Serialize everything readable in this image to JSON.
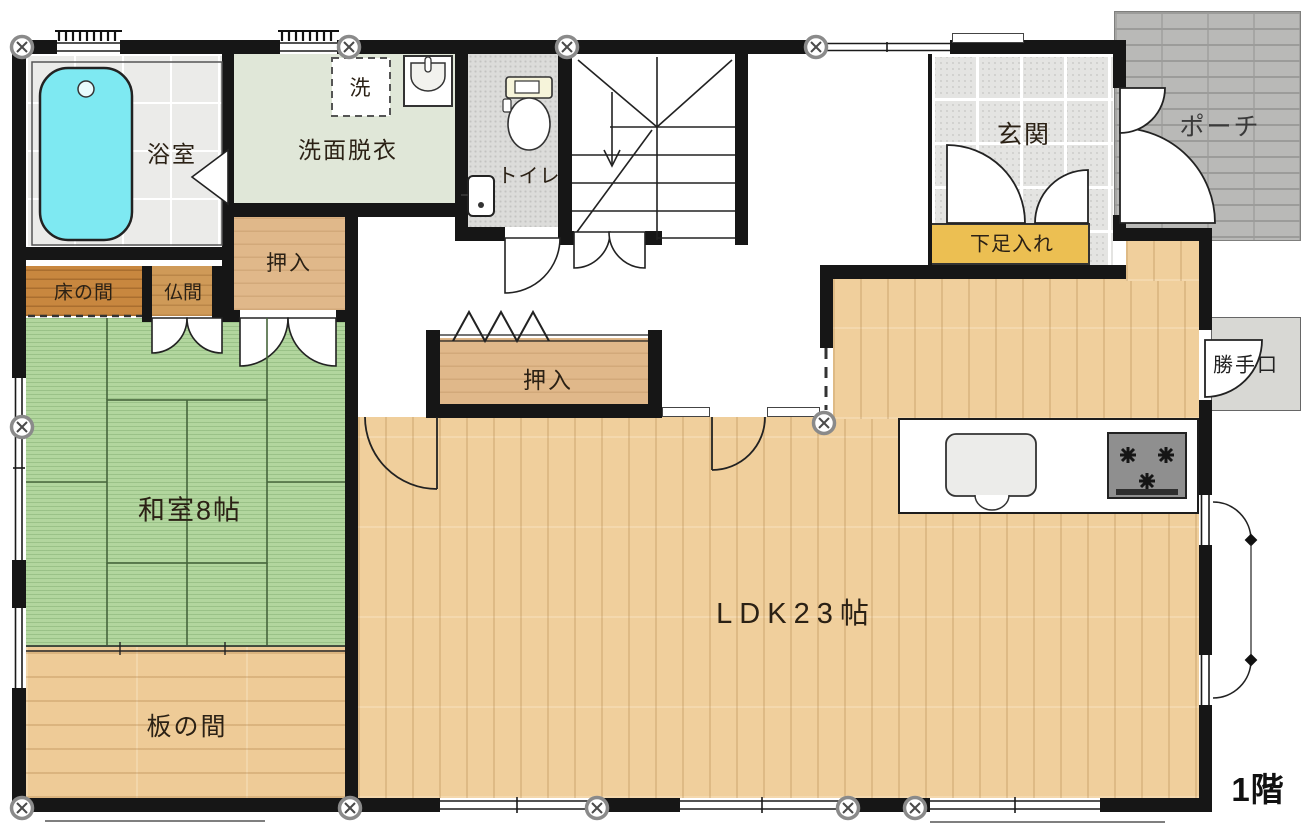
{
  "rooms": {
    "bathroom": {
      "label": "浴室"
    },
    "washroom": {
      "label": "洗面脱衣"
    },
    "washer": {
      "label": "洗"
    },
    "toilet": {
      "label": "トイレ"
    },
    "entrance": {
      "label": "玄関"
    },
    "porch": {
      "label": "ポーチ"
    },
    "shoe_cabinet": {
      "label": "下足入れ"
    },
    "closet_upper": {
      "label": "押入"
    },
    "closet_center": {
      "label": "押入"
    },
    "tokonoma": {
      "label": "床の間"
    },
    "butsuma": {
      "label": "仏間"
    },
    "washitsu": {
      "label": "和室8帖"
    },
    "itanoma": {
      "label": "板の間"
    },
    "ldk": {
      "label": "LDK23帖"
    },
    "back_door": {
      "label": "勝手口"
    },
    "floor": {
      "label": "1階"
    }
  },
  "fixtures": [
    "bathtub",
    "washbasin",
    "washing-machine-space",
    "toilet",
    "hand-basin",
    "staircase-down",
    "kitchen-sink",
    "gas-stove"
  ],
  "colors": {
    "wall": "#161616",
    "tatami": "#b2d69e",
    "wood_floor": "#f0cf9c",
    "plank_floor": "#eecb97",
    "closet_wood": "#e0b88a",
    "tokonoma_wood": "#c8873f",
    "butsuma_wood": "#cf9a58",
    "bathtub": "#7ee9f2",
    "bath_tile": "#ebebe9",
    "washroom_floor": "#e0e7d8",
    "toilet_floor": "#dcdcda",
    "entrance_tile": "#e4e4e2",
    "porch_brick": "#b9b9b7",
    "shoe_cabinet": "#ecbf52",
    "back_door_landing": "#d8d8d4"
  }
}
